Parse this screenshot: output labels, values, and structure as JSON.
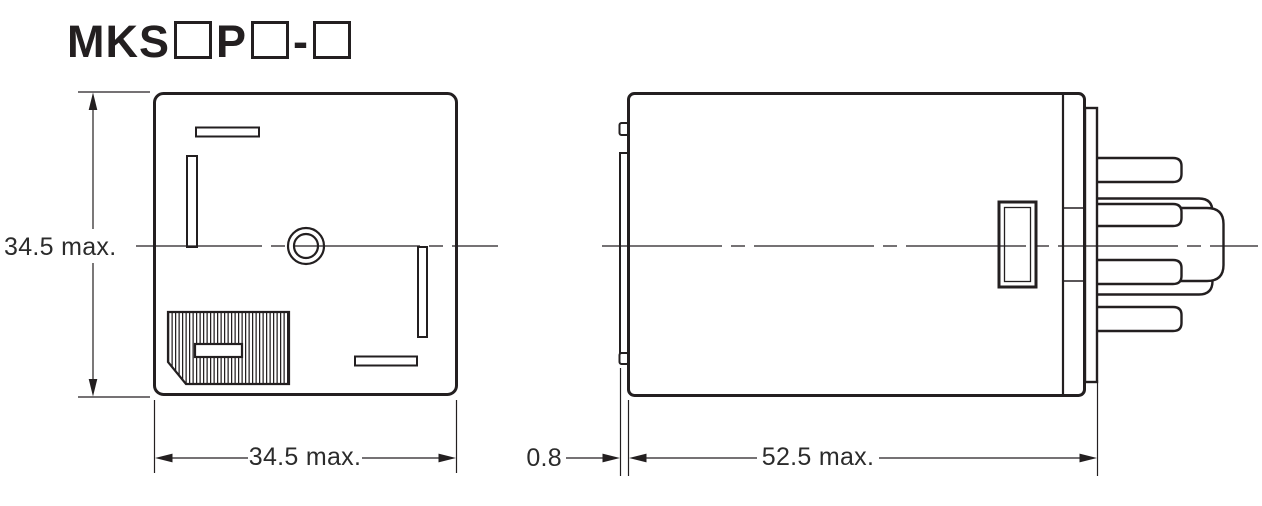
{
  "title": {
    "prefix": "MKS",
    "mid": "P",
    "dash": "-"
  },
  "dimensions": {
    "front_height": "34.5 max.",
    "front_width": "34.5 max.",
    "plate_thickness": "0.8",
    "body_length": "52.5 max."
  },
  "colors": {
    "line": "#231f20",
    "text": "#2b2b2b",
    "background": "#ffffff"
  }
}
